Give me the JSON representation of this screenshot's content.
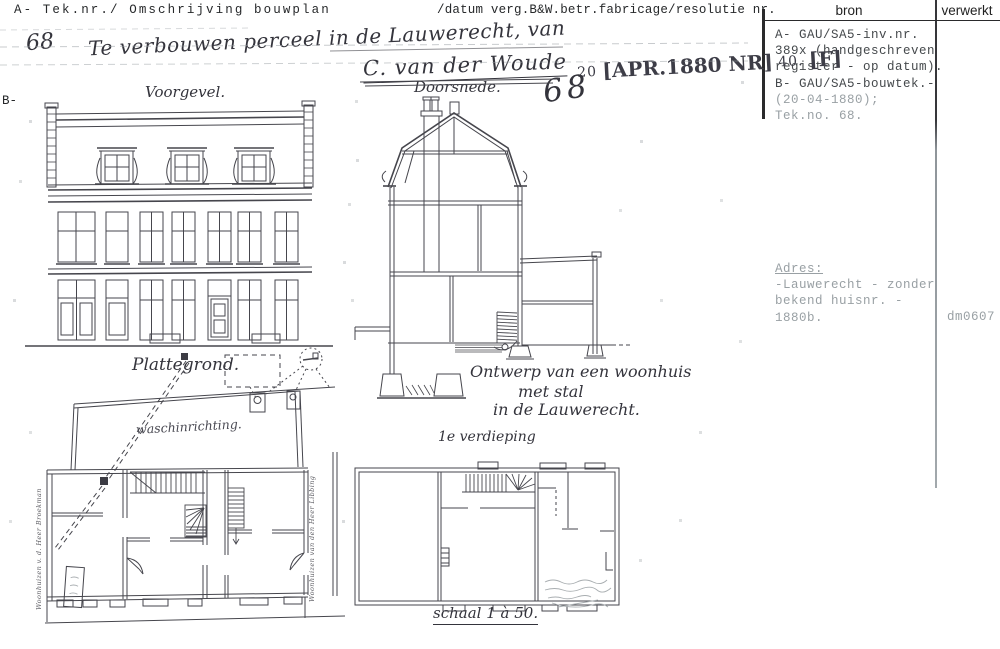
{
  "form": {
    "header_left": "A- Tek.nr./ Omschrijving bouwplan",
    "header_right": "/datum verg.B&W.betr.fabricage/resolutie nr.",
    "margin_b": "B-",
    "bron_title": "bron",
    "verwerkt_title": "verwerkt",
    "bron_entry": [
      "A- GAU/SA5-inv.nr.",
      "389x (handgeschreven",
      "register - op datum).",
      "B- GAU/SA5-bouwtek.-"
    ],
    "bron_entry_faint": [
      "(20-04-1880);",
      "Tek.no. 68."
    ],
    "adres_title": "Adres:",
    "adres_lines": [
      "-Lauwerecht - zonder",
      "bekend huisnr. -",
      "1880b."
    ],
    "verwerkt_code": "dm0607"
  },
  "drawing": {
    "tek_nr_small": "68",
    "title_line": "Te verbouwen perceel in de Lauwerecht, van",
    "owner": "C. van der Woude",
    "stamp": {
      "prefix": "20",
      "bracket1": "[APR.1880 NR]",
      "mid": "40.",
      "bracket2": "[F]"
    },
    "tek_nr_big": "68",
    "labels": {
      "voorgevel": "Voorgevel.",
      "doorsnede": "Doorsnede.",
      "plattegrond": "Plattegrond.",
      "waschinrichting": "waschinrichting.",
      "verdieping": "1e verdieping",
      "schaal": "schaal 1 à 50.",
      "ontwerp1": "Ontwerp van een woonhuis",
      "ontwerp2": "met stal",
      "ontwerp3": "in de Lauwerecht.",
      "side_left": "Woonhuizen v. d. Heer Broekman",
      "side_right": "Woonhuizen van den Heer Libbing"
    }
  },
  "colors": {
    "ink": "#46464d",
    "faded_type": "#99a0a4",
    "rule": "#2a2a2c"
  }
}
